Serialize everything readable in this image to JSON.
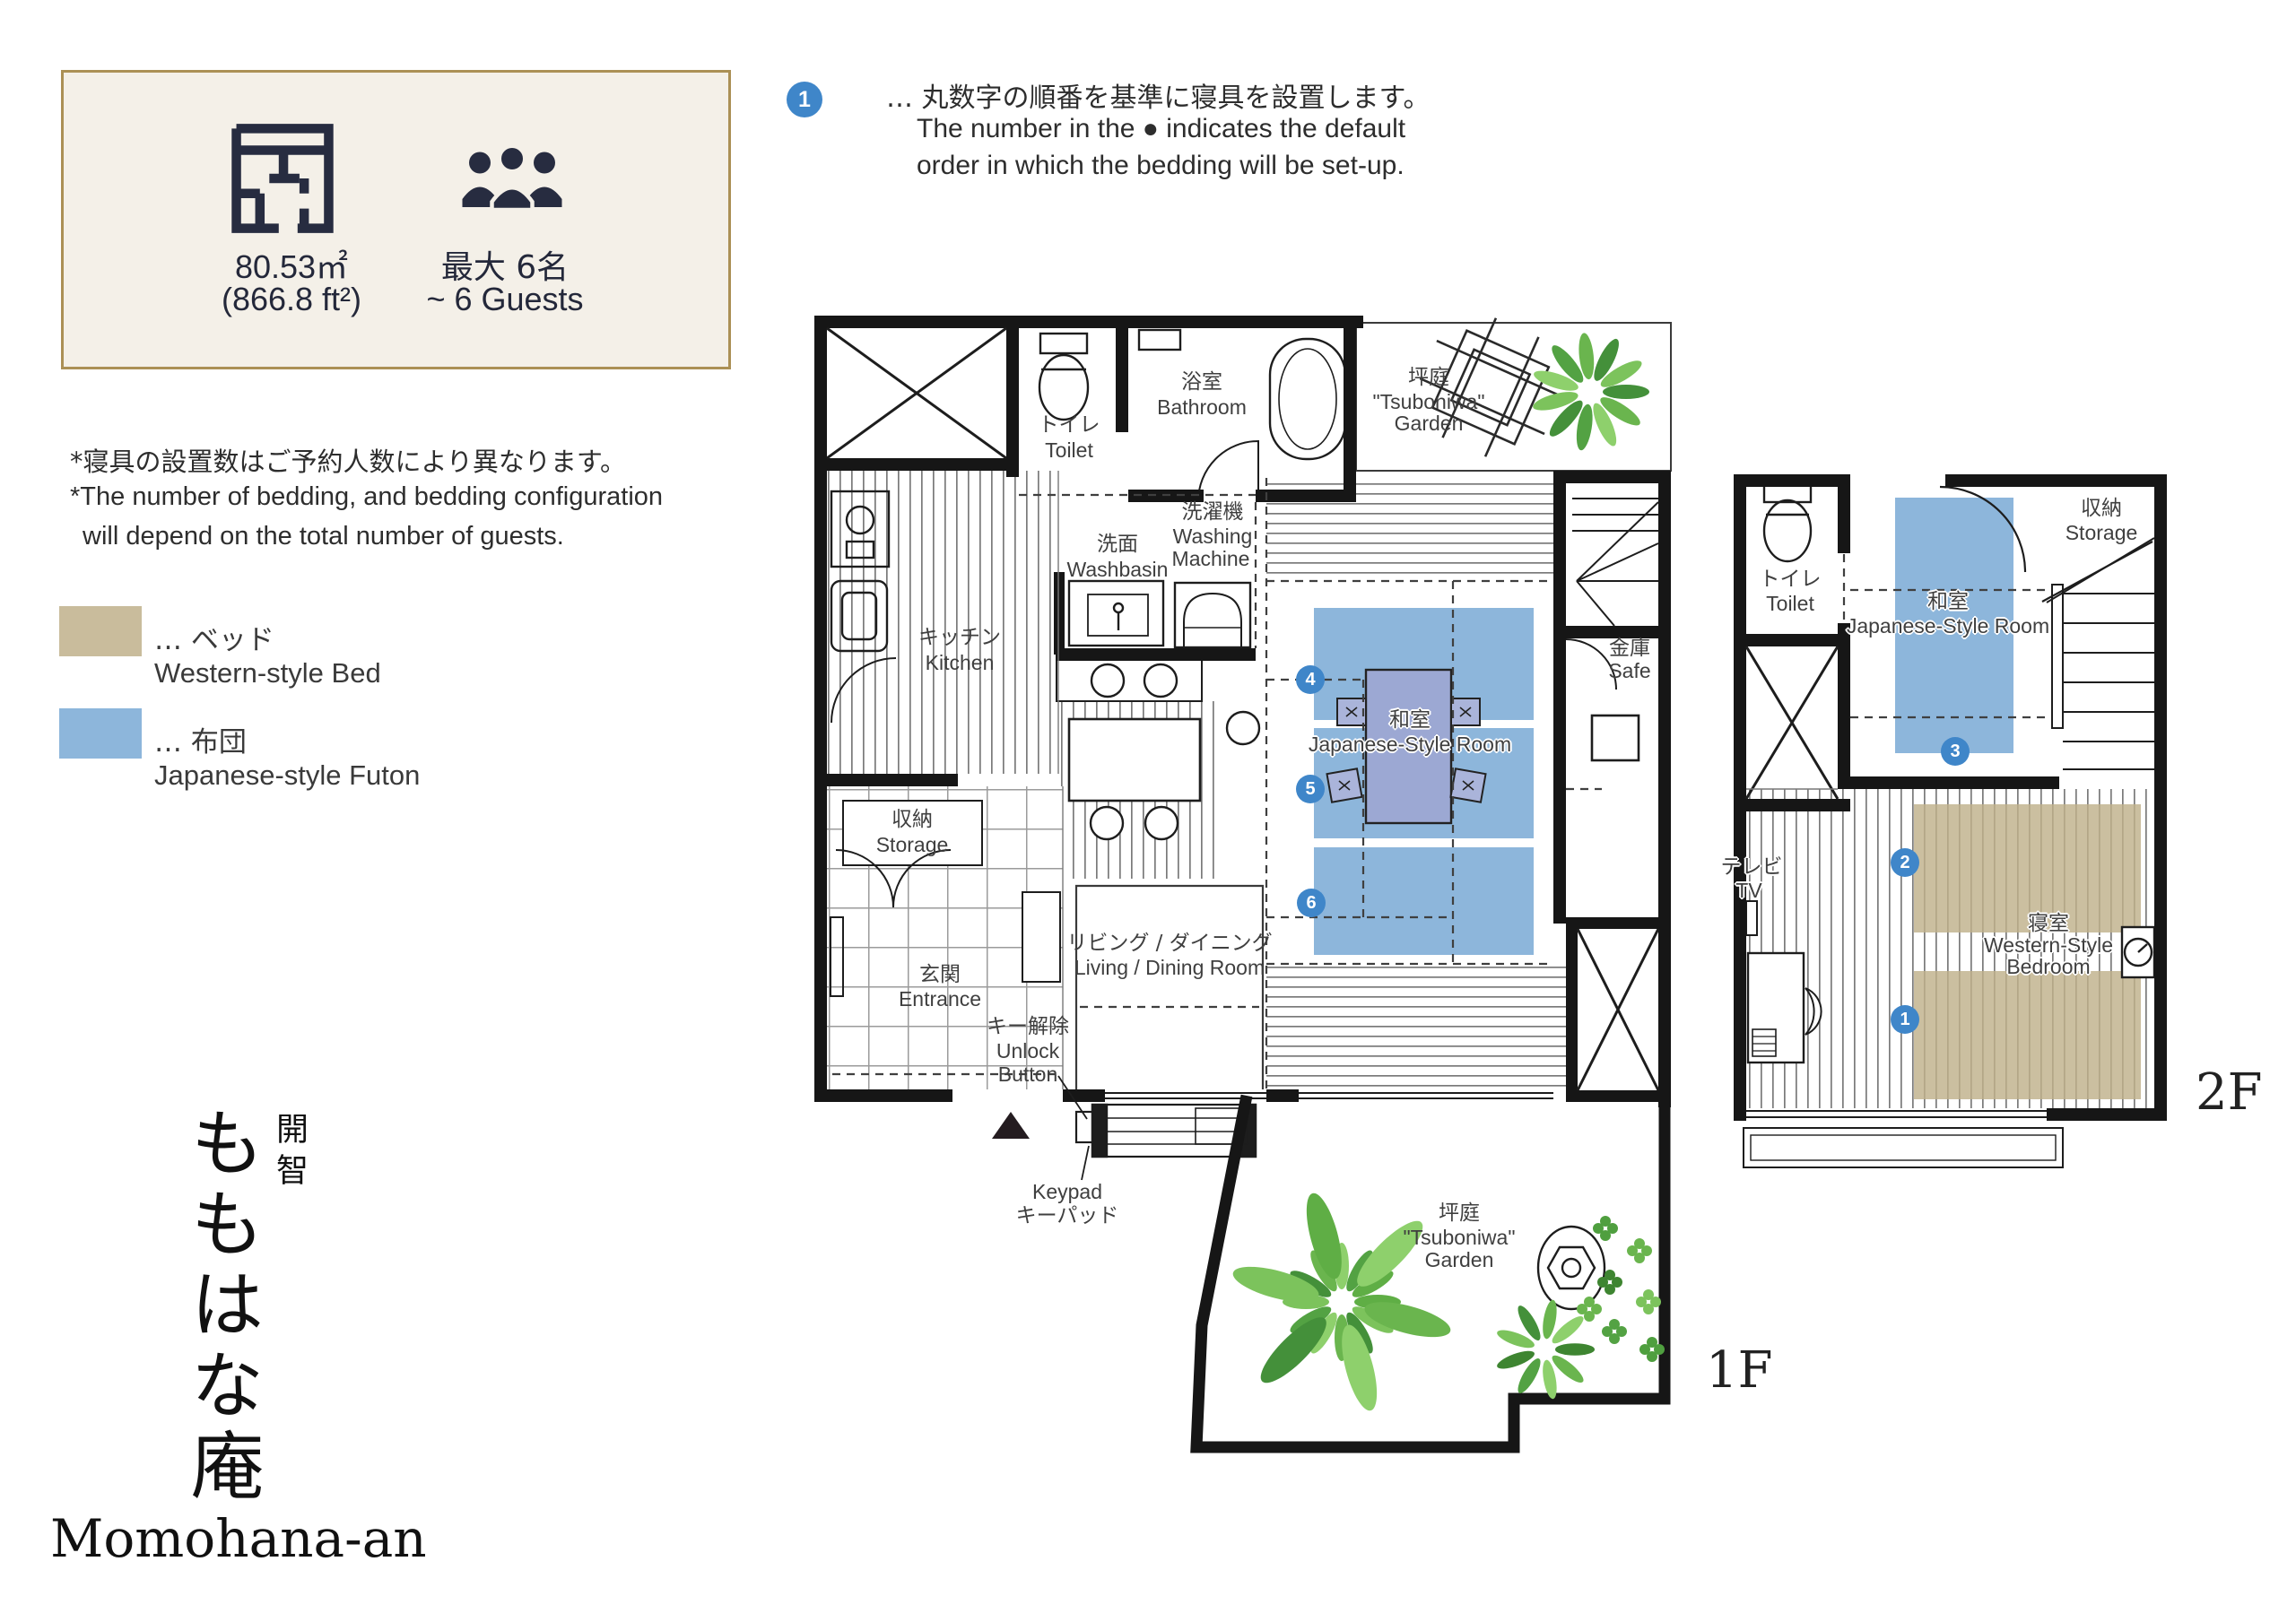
{
  "info_box": {
    "area_m2": "80.53㎡",
    "area_ft2": "(866.8 ft²)",
    "capacity_ja": "最大 6名",
    "capacity_en": "~ 6 Guests"
  },
  "note": {
    "marker": "1",
    "ja": "… 丸数字の順番を基準に寝具を設置します。",
    "en1": "The number in the ● indicates the default",
    "en2": "order in which the bedding will be set-up."
  },
  "disclaimer": {
    "ja": "*寝具の設置数はご予約人数により異なります。",
    "en1": "*The number of bedding, and bedding configuration",
    "en2": "will depend on the total number of guests."
  },
  "legend": {
    "bed_ja": "… ベッド",
    "bed_en": "Western-style Bed",
    "bed_color": "#c9bc9c",
    "futon_ja": "… 布団",
    "futon_en": "Japanese-style Futon",
    "futon_color": "#8db6db"
  },
  "property": {
    "name_side": "開智",
    "name_ja": "ももはな庵",
    "name_en": "Momohana-an"
  },
  "markers": {
    "m1": "1",
    "m2": "2",
    "m3": "3",
    "m4": "4",
    "m5": "5",
    "m6": "6"
  },
  "f1": {
    "floor_label": "1F",
    "toilet_ja": "トイレ",
    "toilet_en": "Toilet",
    "bathroom_ja": "浴室",
    "bathroom_en": "Bathroom",
    "garden_ja": "坪庭",
    "garden_en1": "\"Tsuboniwa\"",
    "garden_en2": "Garden",
    "washbasin_ja": "洗面",
    "washbasin_en": "Washbasin",
    "washing_ja": "洗濯機",
    "washing_en1": "Washing",
    "washing_en2": "Machine",
    "kitchen_ja": "キッチン",
    "kitchen_en": "Kitchen",
    "washitsu_ja": "和室",
    "washitsu_en": "Japanese-Style Room",
    "safe_ja": "金庫",
    "safe_en": "Safe",
    "storage_ja": "収納",
    "storage_en": "Storage",
    "entrance_ja": "玄関",
    "entrance_en": "Entrance",
    "unlock_ja": "キー解除",
    "unlock_en1": "Unlock",
    "unlock_en2": "Button",
    "keypad_en": "Keypad",
    "keypad_ja": "キーパッド",
    "living_ja": "リビング / ダイニング",
    "living_en": "Living / Dining Room",
    "garden2_ja": "坪庭",
    "garden2_en1": "\"Tsuboniwa\"",
    "garden2_en2": "Garden"
  },
  "f2": {
    "floor_label": "2F",
    "toilet_ja": "トイレ",
    "toilet_en": "Toilet",
    "washitsu_ja": "和室",
    "washitsu_en": "Japanese-Style Room",
    "storage_ja": "収納",
    "storage_en": "Storage",
    "tv_ja": "テレビ",
    "tv_en": "TV",
    "bedroom_ja": "寝室",
    "bedroom_en1": "Western-Style",
    "bedroom_en2": "Bedroom"
  }
}
